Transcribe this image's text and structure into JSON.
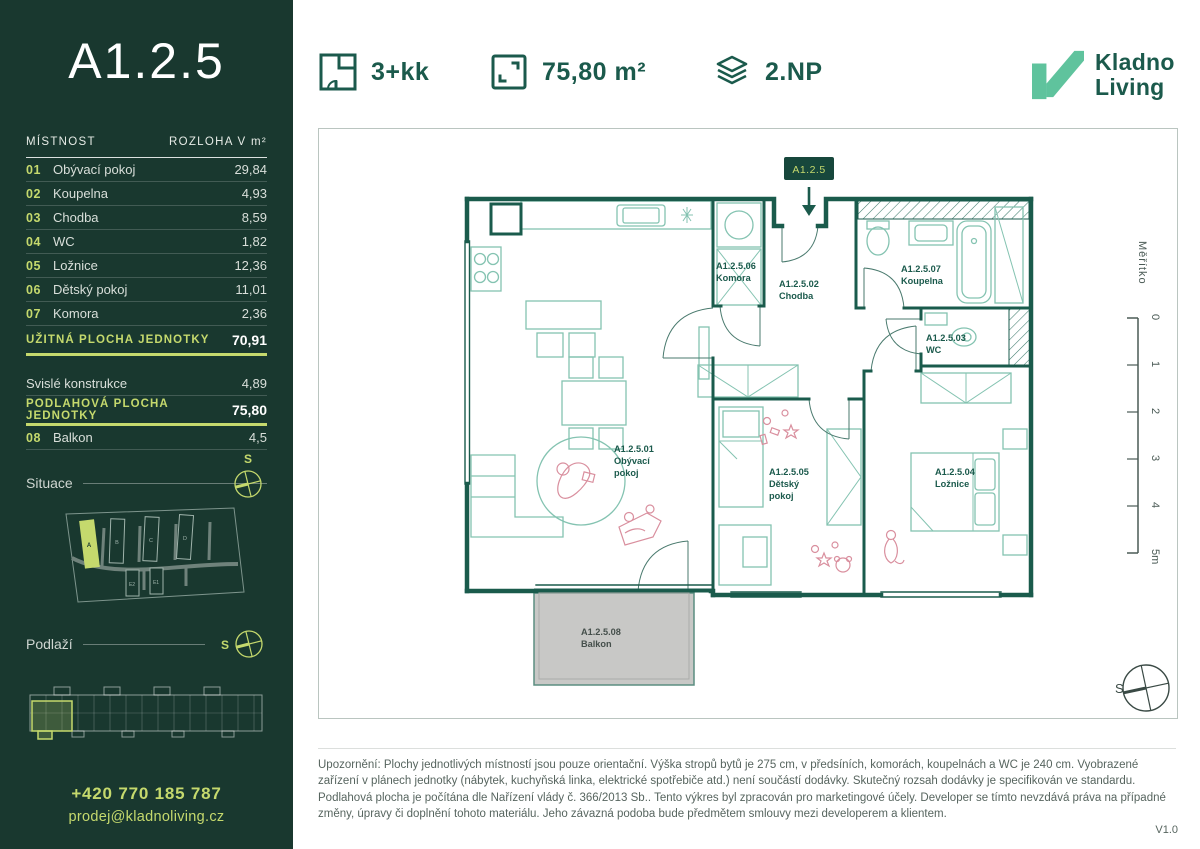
{
  "unit": {
    "code": "A1.2.5"
  },
  "brand": {
    "line1": "Kladno",
    "line2": "Living"
  },
  "specs": {
    "layout": {
      "label": "3+kk"
    },
    "area": {
      "label": "75,80 m²"
    },
    "floor": {
      "label": "2.NP"
    }
  },
  "room_table": {
    "col_room": "MÍSTNOST",
    "col_area": "ROZLOHA V m²",
    "rows": [
      {
        "num": "01",
        "name": "Obývací pokoj",
        "area": "29,84"
      },
      {
        "num": "02",
        "name": "Koupelna",
        "area": "4,93"
      },
      {
        "num": "03",
        "name": "Chodba",
        "area": "8,59"
      },
      {
        "num": "04",
        "name": "WC",
        "area": "1,82"
      },
      {
        "num": "05",
        "name": "Ložnice",
        "area": "12,36"
      },
      {
        "num": "06",
        "name": "Dětský pokoj",
        "area": "11,01"
      },
      {
        "num": "07",
        "name": "Komora",
        "area": "2,36"
      }
    ],
    "usable": {
      "label": "UŽITNÁ PLOCHA JEDNOTKY",
      "value": "70,91"
    },
    "vertical": {
      "label": "Svislé konstrukce",
      "value": "4,89"
    },
    "floor_area": {
      "label": "PODLAHOVÁ PLOCHA JEDNOTKY",
      "value": "75,80"
    },
    "balcony": {
      "num": "08",
      "name": "Balkon",
      "area": "4,5"
    }
  },
  "sections": {
    "situace": "Situace",
    "podlazi": "Podlaží"
  },
  "compass": "S",
  "site": {
    "buildings": [
      "A",
      "B",
      "C",
      "D",
      "E2",
      "E1"
    ]
  },
  "contact": {
    "phone": "+420 770 185 787",
    "email": "prodej@kladnoliving.cz",
    "web": "www.kladnoliving.cz"
  },
  "plan": {
    "badge": "A1.2.5",
    "labels": [
      {
        "code": "A1.2.5.01",
        "line1": "Obývací",
        "line2": "pokoj"
      },
      {
        "code": "A1.2.5.02",
        "line1": "Chodba",
        "line2": ""
      },
      {
        "code": "A1.2.5.03",
        "line1": "WC",
        "line2": ""
      },
      {
        "code": "A1.2.5.04",
        "line1": "Ložnice",
        "line2": ""
      },
      {
        "code": "A1.2.5.05",
        "line1": "Dětský",
        "line2": "pokoj"
      },
      {
        "code": "A1.2.5.06",
        "line1": "Komora",
        "line2": ""
      },
      {
        "code": "A1.2.5.07",
        "line1": "Koupelna",
        "line2": ""
      },
      {
        "code": "A1.2.5.08",
        "line1": "Balkon",
        "line2": ""
      }
    ]
  },
  "scale": {
    "label": "Měřítko",
    "ticks": [
      "0",
      "1",
      "2",
      "3",
      "4",
      "5m"
    ]
  },
  "disclaimer": "Upozornění: Plochy jednotlivých místností jsou pouze orientační. Výška stropů bytů je 275 cm, v předsíních, komorách, koupelnách a WC je 240 cm. Vyobrazené zařízení v plánech jednotky (nábytek, kuchyňská linka, elektrické spotřebiče atd.) není součástí dodávky. Skutečný rozsah dodávky je specifikován ve standardu. Podlahová plocha je počítána dle Nařízení vlády č. 366/2013 Sb.. Tento výkres byl zpracován pro marketingové účely. Developer se tímto nevzdává práva na případné změny, úpravy či doplnění tohoto materiálu. Jeho závazná podoba bude předmětem smlouvy mezi developerem a klientem.",
  "version": "V1.0",
  "colors": {
    "sidebar_bg": "#19382f",
    "accent_green": "#c5d96d",
    "brand_dark": "#1b5a4c",
    "logo_mint": "#5fc39d",
    "wall": "#1a5b4c",
    "furniture": "#84c3b1",
    "figure_pink": "#d98f9e",
    "balcony_fill": "#c8c8c6"
  }
}
